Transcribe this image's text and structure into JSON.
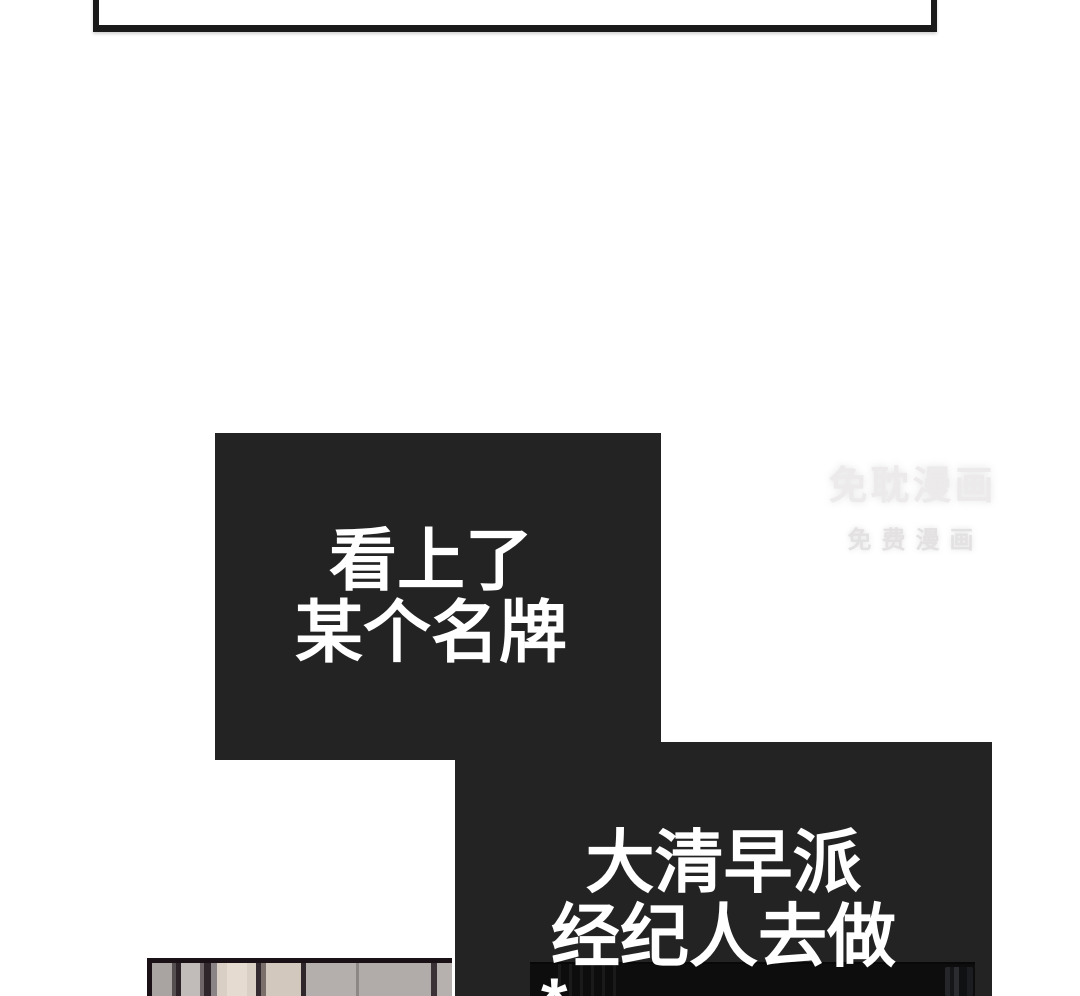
{
  "panels": {
    "speech1": {
      "lines": [
        "看上了",
        "某个名牌"
      ]
    },
    "speech2": {
      "lines": [
        "大清早派",
        "经纪人去做"
      ],
      "footnote_marker": "*"
    }
  },
  "watermark": {
    "title": "免耽漫画",
    "subtitle": "免费漫画"
  },
  "colors": {
    "page_bg": "#ffffff",
    "panel_bg": "#232323",
    "panel_text": "#ffffff",
    "frame_border": "#1a1a1a",
    "watermark_title": "#eceaeb",
    "watermark_subtitle": "#e3e1e2"
  }
}
